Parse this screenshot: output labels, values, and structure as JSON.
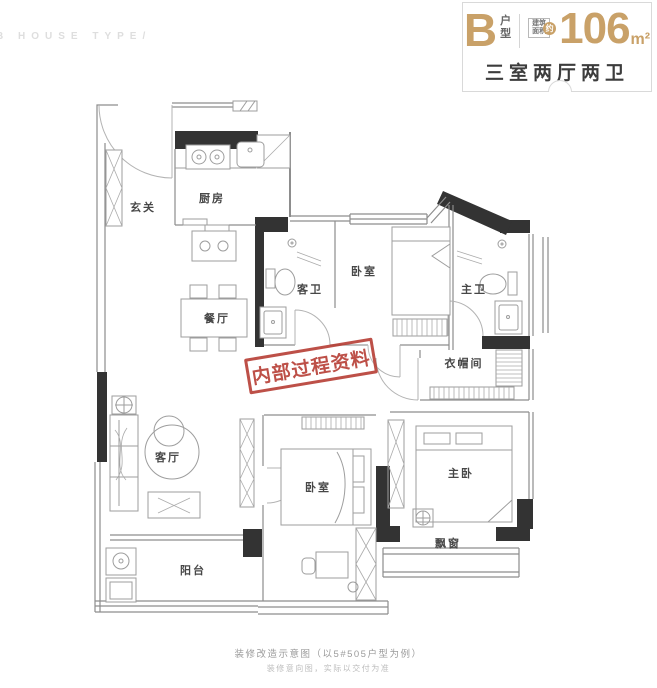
{
  "watermark": "B HOUSE TYPE/",
  "header": {
    "type_letter": "B",
    "type_suffix_top": "户",
    "type_suffix_bottom": "型",
    "area_label_top": "建筑",
    "area_label_bottom": "面积",
    "area_approx": "约",
    "area_value": "106",
    "area_unit": "m²",
    "subtitle": "三室两厅两卫"
  },
  "plan": {
    "stamp": "内部过程资料",
    "rooms": [
      {
        "name": "entry",
        "label": "玄关"
      },
      {
        "name": "kitchen",
        "label": "厨房"
      },
      {
        "name": "dining",
        "label": "餐厅"
      },
      {
        "name": "guest-bath",
        "label": "客卫"
      },
      {
        "name": "bedroom-north",
        "label": "卧室"
      },
      {
        "name": "master-bath",
        "label": "主卫"
      },
      {
        "name": "cloakroom",
        "label": "衣帽间"
      },
      {
        "name": "living",
        "label": "客厅"
      },
      {
        "name": "bedroom-south",
        "label": "卧室"
      },
      {
        "name": "master-bedroom",
        "label": "主卧"
      },
      {
        "name": "bay-window",
        "label": "飘窗"
      },
      {
        "name": "balcony",
        "label": "阳台"
      }
    ]
  },
  "footer": {
    "line1": "装修改造示意图（以5#505户型为例）",
    "line2": "装修意向图，实际以交付为准"
  },
  "colors": {
    "gold": "#c9a168",
    "stamp_red": "#b5392f",
    "wall": "#333333"
  }
}
